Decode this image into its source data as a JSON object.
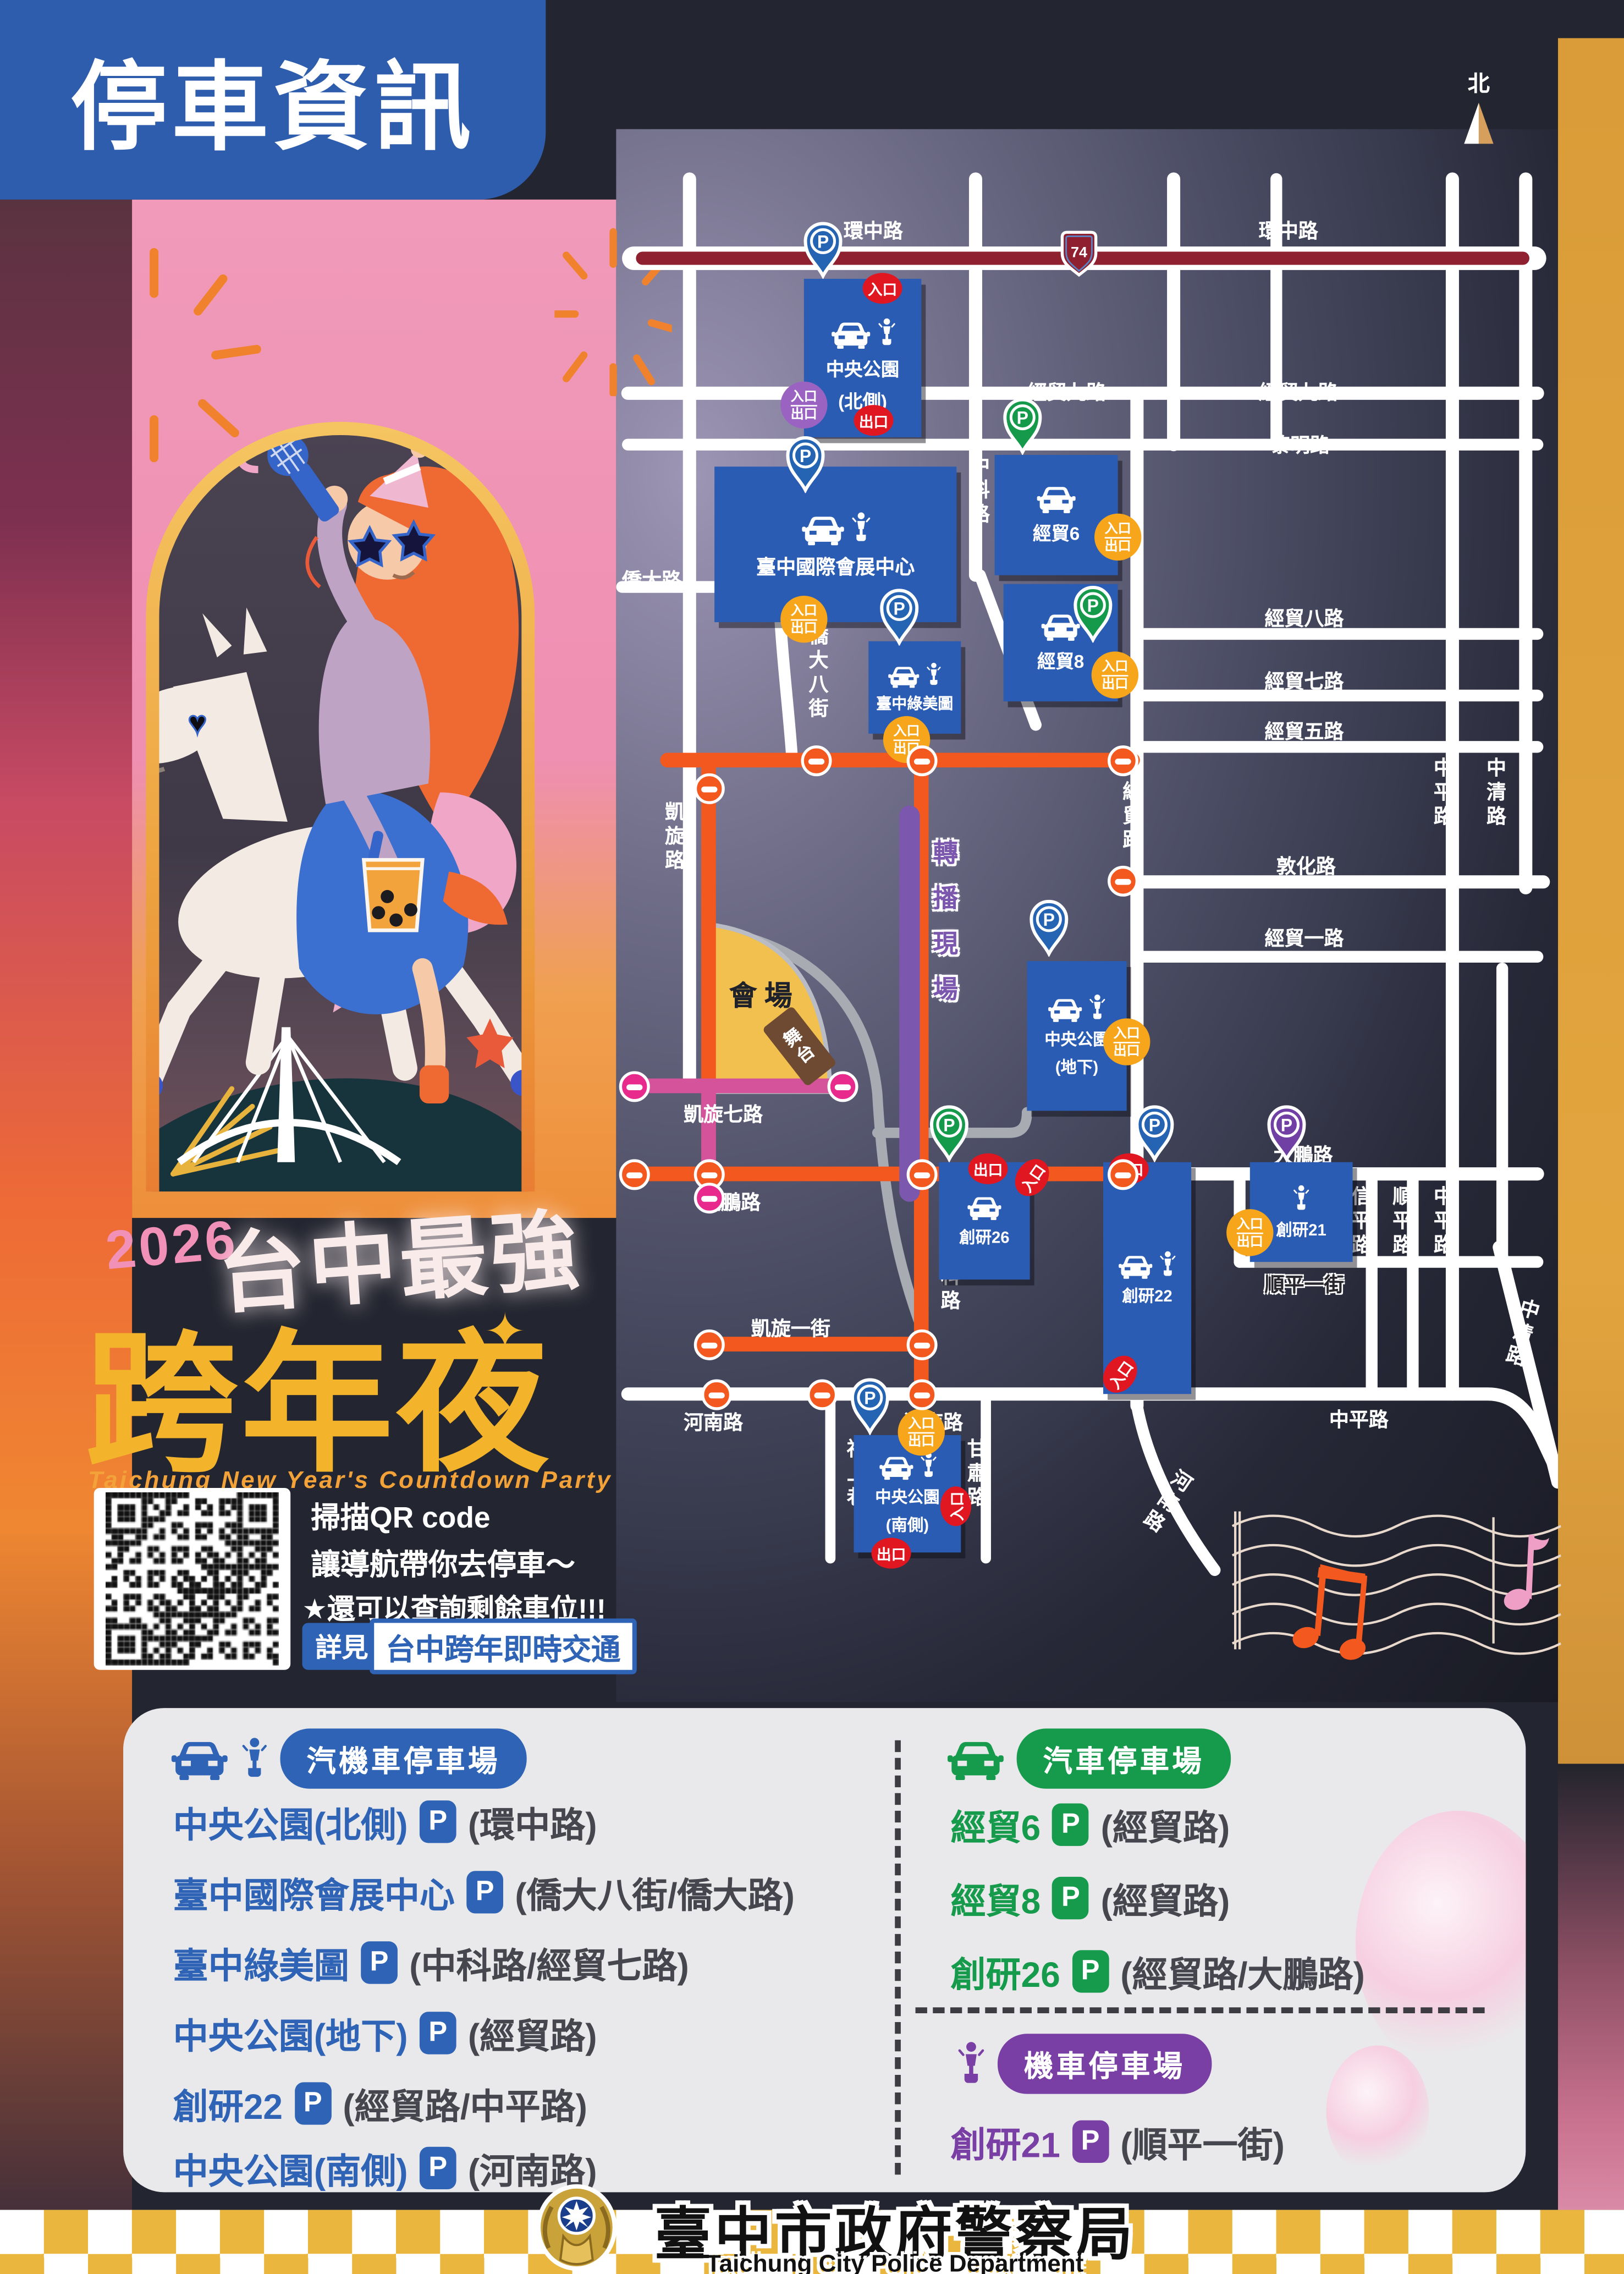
{
  "title": "停車資訊",
  "p": "P",
  "north_label": "北",
  "expressway_number": "74",
  "hero": {
    "year": "2026",
    "tagline": "台中最強",
    "headline": "跨年夜",
    "sparkle": "✦",
    "english": "Taichung New Year's Countdown Party"
  },
  "qr": {
    "line1": "掃描QR code",
    "line2": "讓導航帶你去停車～",
    "line3": "★還可以查詢剩餘車位!!!",
    "see": "詳見",
    "link": "台中跨年即時交通"
  },
  "map": {
    "badges": {
      "in": "入口",
      "out": "出口"
    },
    "venue": {
      "label": "會場",
      "stage": "舞台"
    },
    "labels": {
      "huanzhong_w": "環中路",
      "huanzhong_e": "環中路",
      "jingmao9_w": "經貿九路",
      "jingmao9_e": "經貿九路",
      "liming": "黎明路",
      "qiaoda": "僑大路",
      "qiaoda8": "僑大八街",
      "zhongke_n": "中科路",
      "zhongke_s": "中科路",
      "jingmao8": "經貿八路",
      "jingmao7": "經貿七路",
      "jingmao5": "經貿五路",
      "dunhua": "敦化路",
      "jingmao1": "經貿一路",
      "jingmao_n": "經貿路",
      "jingmao_s": "經貿路",
      "kaixuan": "凱旋路",
      "kaixuan7": "凱旋七路",
      "kaixuan1": "凱旋一街",
      "dapeng_w": "大鵬路",
      "dapeng_e": "大鵬路",
      "henan_w": "河南路",
      "henan_m": "河南路",
      "henan_se": "河南路",
      "zhongping_v1": "中平路",
      "zhongping_v2": "中平路",
      "zhongping_s": "中平路",
      "zhongqing_n": "中清路",
      "zhongqing_s": "中清路",
      "xinping": "信平路",
      "shunping": "順平路",
      "shunping1": "順平一街",
      "fushang": "福上巷",
      "gansu": "甘肅路",
      "broadcast": "轉播現場"
    },
    "lots": {
      "north_park": {
        "name": "中央公園",
        "sub": "(北側)"
      },
      "expo": {
        "name": "臺中國際會展中心"
      },
      "greenmuseum": {
        "name": "臺中綠美圖"
      },
      "jingmao6": {
        "name": "經貿6"
      },
      "jingmao8": {
        "name": "經貿8"
      },
      "underground": {
        "name": "中央公園",
        "sub": "(地下)"
      },
      "cy26": {
        "name": "創研26"
      },
      "cy22": {
        "name": "創研22"
      },
      "cy21": {
        "name": "創研21"
      },
      "south_park": {
        "name": "中央公園",
        "sub": "(南側)"
      }
    }
  },
  "legend": {
    "combined": {
      "title": "汽機車停車場",
      "items": [
        {
          "name": "中央公園(北側)",
          "location": "(環中路)"
        },
        {
          "name": "臺中國際會展中心",
          "location": "(僑大八街/僑大路)"
        },
        {
          "name": "臺中綠美圖",
          "location": "(中科路/經貿七路)"
        },
        {
          "name": "中央公園(地下)",
          "location": "(經貿路)"
        },
        {
          "name": "創研22",
          "location": "(經貿路/中平路)"
        },
        {
          "name": "中央公園(南側)",
          "location": "(河南路)"
        }
      ]
    },
    "car": {
      "title": "汽車停車場",
      "items": [
        {
          "name": "經貿6",
          "location": "(經貿路)"
        },
        {
          "name": "經貿8",
          "location": "(經貿路)"
        },
        {
          "name": "創研26",
          "location": "(經貿路/大鵬路)"
        }
      ]
    },
    "moto": {
      "title": "機車停車場",
      "items": [
        {
          "name": "創研21",
          "location": "(順平一街)"
        }
      ]
    }
  },
  "footer": {
    "org": "臺中市政府警察局",
    "org_en": "Taichung City Police Department"
  }
}
